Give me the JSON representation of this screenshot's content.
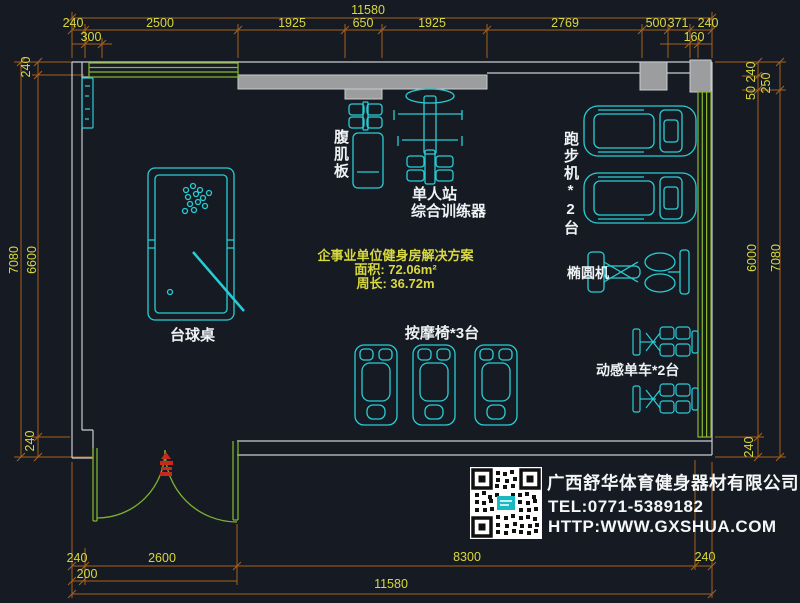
{
  "colors": {
    "background": "#161b23",
    "dimension_line": "#a8601e",
    "dimension_text": "#d8d83f",
    "wall_fill": "#9b9d9f",
    "wall_outline": "#c9cbcd",
    "window_green": "#8ab92d",
    "equipment_cyan": "#28ccd4",
    "label_white": "#eef2f4",
    "door_marker_red": "#c8281e"
  },
  "dims": {
    "top": {
      "overall": "11580",
      "chain": [
        "240",
        "2500",
        "1925",
        "650",
        "1925",
        "2769",
        "500",
        "371",
        "240"
      ],
      "sub_left": "300",
      "sub_right": "160"
    },
    "left": {
      "wall_top": "240",
      "outer": "7080",
      "inner": "6600",
      "wall_bottom": "240"
    },
    "right": {
      "wall_top": "240",
      "gap": "50",
      "top_outer": "250",
      "inner": "6000",
      "outer": "7080",
      "wall_bottom": "240"
    },
    "bottom": {
      "chain": [
        "240",
        "2600",
        "8300",
        "240"
      ],
      "sub_left": "200",
      "overall": "11580"
    }
  },
  "equipment": {
    "pool_table": "台球桌",
    "abs_board": "腹肌板",
    "trainer_line1": "单人站",
    "trainer_line2": "综合训练器",
    "treadmills": "跑步机*2台",
    "elliptical": "椭圆机",
    "massage_chairs": "按摩椅*3台",
    "spin_bikes": "动感单车*2台"
  },
  "plan_info": {
    "title": "企事业单位健身房解决方案",
    "area": "面积: 72.06m²",
    "perimeter": "周长: 36.72m"
  },
  "company": {
    "name": "广西舒华体育健身器材有限公司",
    "tel": "TEL:0771-5389182",
    "website": "HTTP:WWW.GXSHUA.COM"
  }
}
